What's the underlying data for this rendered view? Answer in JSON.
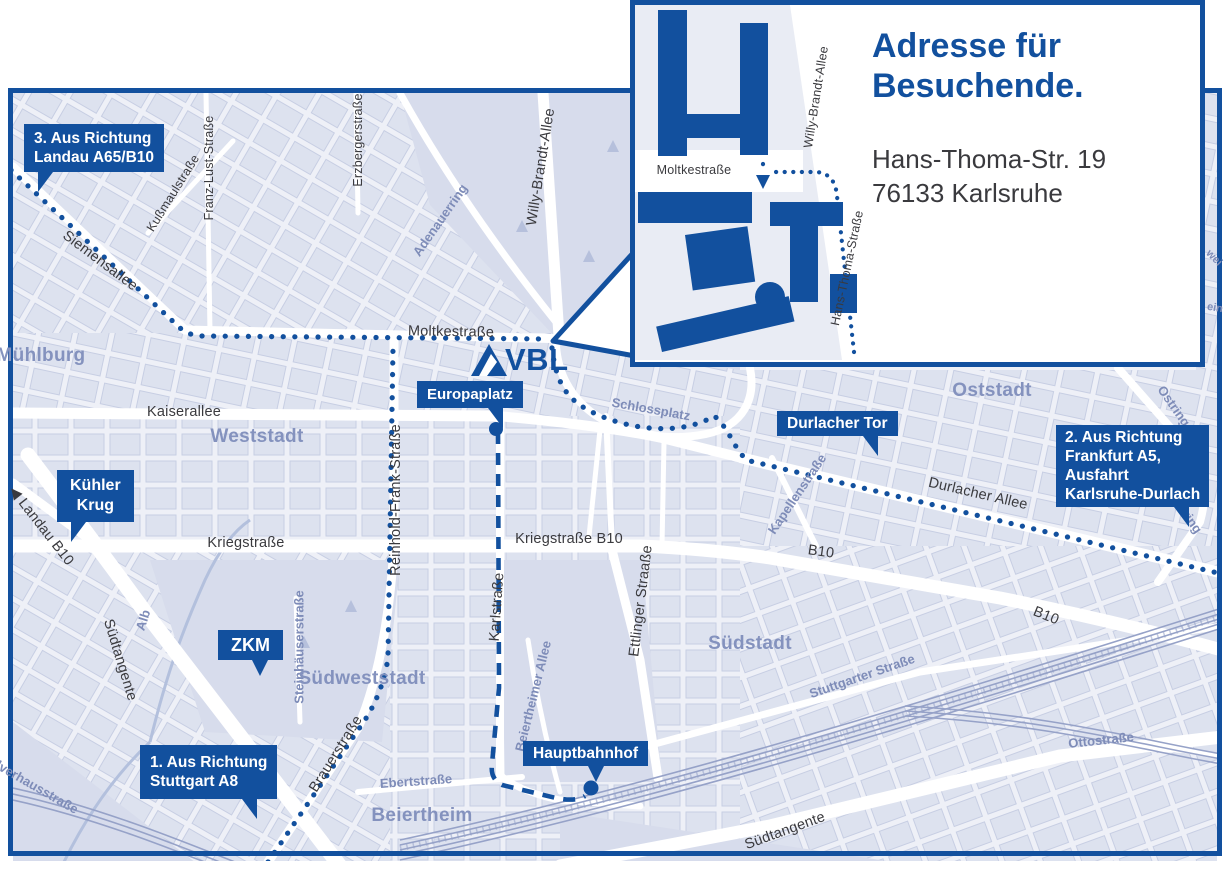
{
  "colors": {
    "brand_blue": "#12509E",
    "map_background": "#EEF0F7",
    "block_fill": "#DDE2EF",
    "block_stroke": "#C7CEE3",
    "park_fill": "#D7DCEC",
    "rail_line": "#96A2C8",
    "dark_street_label": "#3A3A3E",
    "minor_street_label": "#7E8CB8",
    "area_label": "#8492BE"
  },
  "logo": {
    "text": "VBL"
  },
  "inset": {
    "heading_line1": "Adresse für",
    "heading_line2": "Besuchende.",
    "address_line1": "Hans-Thoma-Str. 19",
    "address_line2": "76133 Karlsruhe",
    "streets": [
      {
        "text": "Moltkestraße"
      },
      {
        "text": "Willy-Brandt-Allee"
      },
      {
        "text": "Hans-Thoma-Straße"
      }
    ]
  },
  "map": {
    "callouts": {
      "route3": {
        "lines": [
          "3. Aus Richtung",
          "Landau A65/B10"
        ]
      },
      "kuehler_krug": {
        "lines": [
          "Kühler",
          "Krug"
        ]
      },
      "zkm": {
        "lines": [
          "ZKM"
        ]
      },
      "route1": {
        "lines": [
          "1. Aus Richtung",
          "Stuttgart A8"
        ]
      },
      "europaplatz": {
        "lines": [
          "Europaplatz"
        ]
      },
      "durlacher_tor": {
        "lines": [
          "Durlacher Tor"
        ]
      },
      "route2": {
        "lines": [
          "2. Aus Richtung",
          "Frankfurt A5,",
          "Ausfahrt",
          "Karlsruhe-Durlach"
        ]
      },
      "hauptbahnhof": {
        "lines": [
          "Hauptbahnhof"
        ]
      }
    },
    "streets": [
      {
        "text": "Siemensallee"
      },
      {
        "text": "Kußmaulstraße"
      },
      {
        "text": "Franz-Lust-Straße"
      },
      {
        "text": "Erzbergerstraße"
      },
      {
        "text": "Willy-Brandt-Allee"
      },
      {
        "text": "Moltkestraße"
      },
      {
        "text": "Kaiserallee"
      },
      {
        "text": "Kriegstraße"
      },
      {
        "text": "Kriegstraße B10"
      },
      {
        "text": "Reinhold-Frank-Straße"
      },
      {
        "text": "Karlstraße"
      },
      {
        "text": "Ettlinger Straaße"
      },
      {
        "text": "Durlacher Allee"
      },
      {
        "text": "B10"
      },
      {
        "text": "B10"
      },
      {
        "text": "◀ Landau B10"
      },
      {
        "text": "Südtangente"
      },
      {
        "text": "Südtangente"
      },
      {
        "text": "Brauerstraße"
      }
    ],
    "minor_streets": [
      {
        "text": "Adenauerring"
      },
      {
        "text": "Schlossplatz"
      },
      {
        "text": "Kapellenstraße"
      },
      {
        "text": "Ostring"
      },
      {
        "text": "Ostring"
      },
      {
        "text": "Steinhäuserstraße"
      },
      {
        "text": "Alb"
      },
      {
        "text": "Stuttgarter Straße"
      },
      {
        "text": "Ottostraße"
      },
      {
        "text": "Beiertheimer Allee"
      },
      {
        "text": "Ebertstraße"
      },
      {
        "text": "Pulverhausstraße"
      },
      {
        "text": "wei"
      },
      {
        "text": "ein"
      }
    ],
    "areas": [
      {
        "text": "Mühlburg"
      },
      {
        "text": "Weststadt"
      },
      {
        "text": "Oststadt"
      },
      {
        "text": "Südstadt"
      },
      {
        "text": "Südweststadt"
      },
      {
        "text": "Beiertheim"
      }
    ]
  }
}
